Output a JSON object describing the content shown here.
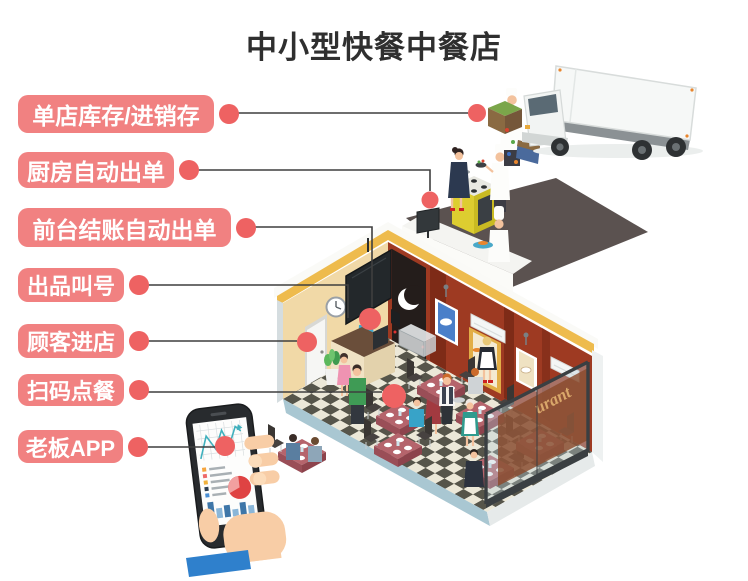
{
  "title": "中小型快餐中餐店",
  "labels": [
    {
      "text": "单店库存/进销存"
    },
    {
      "text": "厨房自动出单"
    },
    {
      "text": "前台结账自动出单"
    },
    {
      "text": "出品叫号"
    },
    {
      "text": "顾客进店"
    },
    {
      "text": "扫码点餐"
    },
    {
      "text": "老板APP"
    }
  ],
  "restaurant_sign": "urant",
  "colors": {
    "label_pill": "#f18181",
    "callout_dot": "#ee6262",
    "callout_line": "#3f3f3f",
    "title_text": "#2f2f2f",
    "wall_tan": "#f1d9a7",
    "wall_red": "#9e3a22",
    "roof_trim_yellow": "#eebb4d",
    "kitchen_floor": "#5b5250",
    "glass_sign_panel": "#8a4a2c",
    "glass_sign_text": "#d9a76a",
    "phone_chart_teal": "#3fb0bd",
    "hand_skin": "#f8cda6",
    "sleeve_blue": "#2f80cc"
  }
}
